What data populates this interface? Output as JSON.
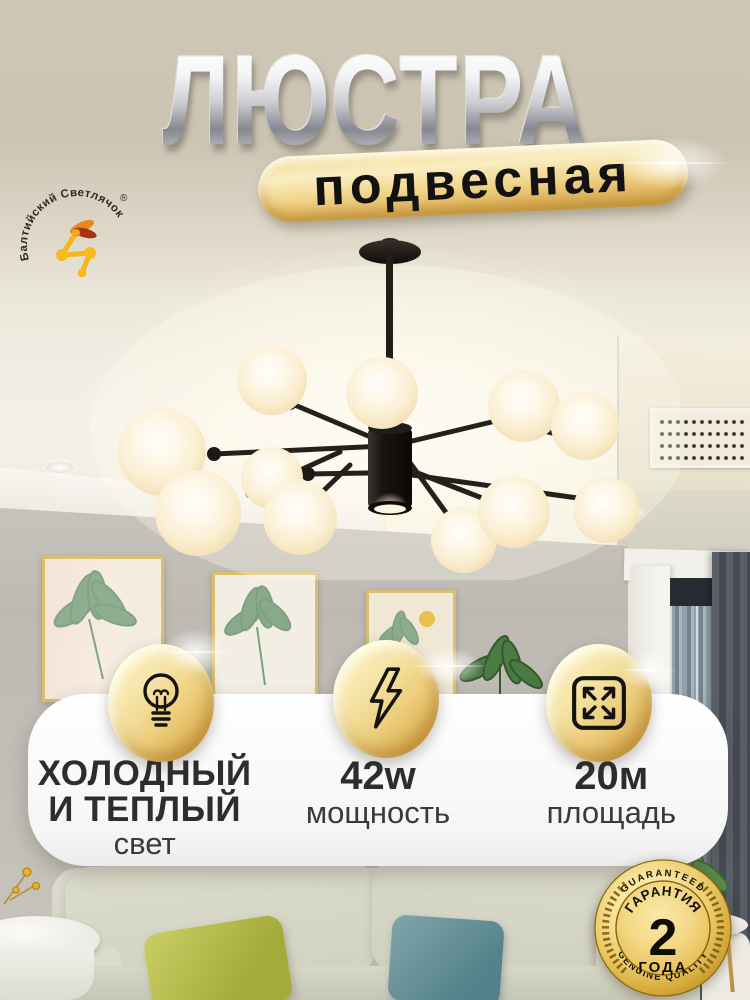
{
  "brand": {
    "arc_text": "Балтийский Светлячок",
    "reg_mark": "®",
    "icon": "firefly-icon"
  },
  "title": {
    "main": "ЛЮСТРА",
    "badge": "подвесная"
  },
  "features": {
    "light": {
      "icon": "lightbulb-icon",
      "line1": "ХОЛОДНЫЙ",
      "line2": "И ТЕПЛЫЙ",
      "line3": "свет"
    },
    "power": {
      "icon": "lightning-icon",
      "value": "42w",
      "label": "мощность"
    },
    "area": {
      "icon": "expand-arrows-icon",
      "value": "20м",
      "label": "площадь"
    }
  },
  "warranty": {
    "icon": "gold-medal-badge",
    "arc_top": "GUARANTEED",
    "arc_bottom": "GENUINE QUALITY",
    "name": "ГАРАНТИЯ",
    "value": "2",
    "unit": "ГОДА"
  },
  "colors": {
    "backdrop": "#cdc5b4",
    "gold_light": "#f8ecc0",
    "gold_dark": "#d8a74c",
    "card_bg": "#ffffff",
    "text_dark": "#2e2e2e",
    "badge_text": "#171106"
  }
}
